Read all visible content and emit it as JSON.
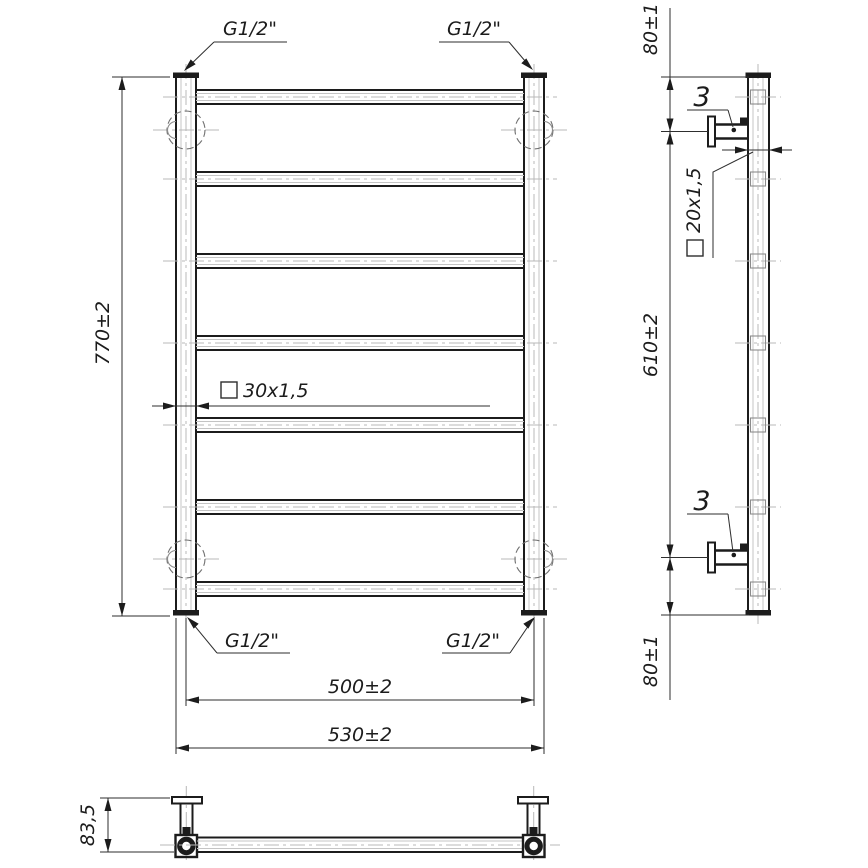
{
  "front_view": {
    "rung_count": 7,
    "height_dim": "770±2",
    "axis_width_dim": "500±2",
    "overall_width_dim": "530±2",
    "post_profile": "30x1,5",
    "thread_top_left": "G1/2\"",
    "thread_top_right": "G1/2\"",
    "thread_bottom_left": "G1/2\"",
    "thread_bottom_right": "G1/2\""
  },
  "side_view": {
    "top_offset_dim": "80±1",
    "bracket_span_dim": "610±2",
    "bottom_offset_dim": "80±1",
    "rung_profile": "20x1,5",
    "bracket_item_top": "3",
    "bracket_item_bottom": "3"
  },
  "bottom_view": {
    "depth_dim": "83,5"
  },
  "colors": {
    "outline": "#1c1c1c",
    "dimension": "#2e2e2e",
    "centerline": "#b8b8b8",
    "hidden": "#6f6f6f",
    "background": "#ffffff"
  }
}
